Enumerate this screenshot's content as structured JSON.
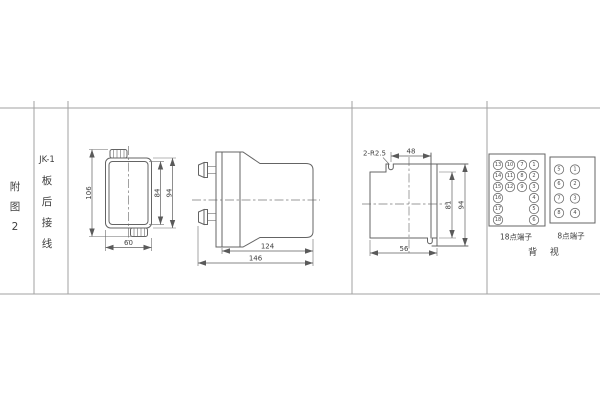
{
  "sidebar": {
    "figure_label": [
      "附",
      "图",
      "2"
    ],
    "title_chars": [
      "JK-1",
      "板",
      "后",
      "接",
      "线"
    ]
  },
  "front_view": {
    "dim_total_height": "106",
    "dim_inner_height": "84",
    "dim_body_height": "94",
    "dim_width": "60"
  },
  "side_view": {
    "dim_body_depth": "124",
    "dim_total_depth": "146"
  },
  "panel_view": {
    "slot_note": "2-R2.5",
    "dim_slot_span": "48",
    "dim_inner_height": "81",
    "dim_outer_height": "94",
    "dim_width": "56"
  },
  "terminals": {
    "block18": {
      "label": "18点端子",
      "col1": [
        "13",
        "14",
        "15",
        "16",
        "17",
        "18"
      ],
      "col2": [
        "10",
        "11",
        "12"
      ],
      "col3": [
        "7",
        "8",
        "9"
      ],
      "col4": [
        "1",
        "2",
        "3",
        "4",
        "5",
        "6"
      ]
    },
    "block8": {
      "label": "8点端子",
      "col1": [
        "5",
        "6",
        "7",
        "8"
      ],
      "col2": [
        "1",
        "2",
        "3",
        "4"
      ]
    },
    "view_label": "背 视"
  }
}
